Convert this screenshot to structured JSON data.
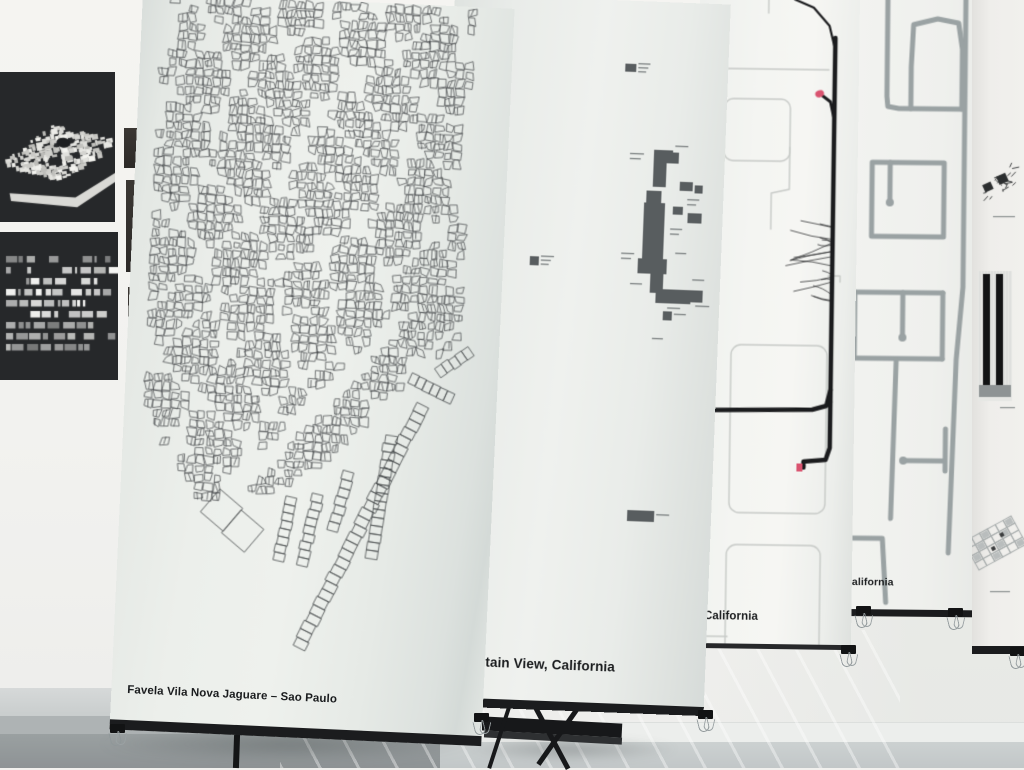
{
  "labels": {
    "banner1": "Favela Vila Nova Jaguare – Sao Paulo",
    "banner2": "tain View, California",
    "banner3": ", California",
    "banner3_faint": "n",
    "banner4": "alifornia"
  },
  "colors": {
    "mapLine": "#3d4143",
    "campus": "#585d5f",
    "campusDash": "#73787a",
    "routeBlack": "#1b1c1e",
    "routeGrey": "#c7cac7",
    "pink": "#d9536f",
    "road": "#9aa2a3",
    "art": "#26282a"
  },
  "favela": {
    "w": 372,
    "h": 730,
    "cell": 9,
    "seed": 11,
    "sil": [
      [
        30,
        0
      ],
      [
        338,
        0
      ],
      [
        334,
        62
      ],
      [
        324,
        132
      ],
      [
        330,
        212
      ],
      [
        342,
        272
      ],
      [
        334,
        338
      ],
      [
        300,
        368
      ],
      [
        266,
        402
      ],
      [
        232,
        434
      ],
      [
        204,
        458
      ],
      [
        178,
        482
      ],
      [
        148,
        496
      ],
      [
        104,
        508
      ],
      [
        80,
        510
      ],
      [
        58,
        472
      ],
      [
        36,
        446
      ],
      [
        26,
        420
      ],
      [
        20,
        392
      ],
      [
        30,
        350
      ],
      [
        16,
        318
      ],
      [
        22,
        280
      ],
      [
        16,
        240
      ],
      [
        26,
        200
      ],
      [
        14,
        164
      ],
      [
        30,
        124
      ],
      [
        18,
        80
      ],
      [
        42,
        44
      ]
    ],
    "streets": [
      [
        262,
        330,
        108,
        500,
        9
      ],
      [
        330,
        344,
        296,
        370,
        6
      ]
    ],
    "ladders": [
      [
        298,
        400,
        185,
        648,
        13,
        30
      ],
      [
        312,
        368,
        344,
        344,
        11,
        5
      ],
      [
        284,
        374,
        328,
        392,
        11,
        6
      ],
      [
        268,
        432,
        254,
        556,
        12,
        15
      ],
      [
        198,
        494,
        184,
        566,
        11,
        9
      ],
      [
        172,
        498,
        160,
        562,
        11,
        8
      ],
      [
        228,
        470,
        214,
        530,
        11,
        7
      ]
    ],
    "squares": [
      [
        102,
        514,
        30,
        38
      ],
      [
        124,
        534,
        30,
        38
      ]
    ]
  },
  "campus": {
    "w": 276,
    "h": 710,
    "rects": [
      [
        173,
        63,
        11,
        8
      ],
      [
        205,
        148,
        19,
        13
      ],
      [
        205,
        161,
        13,
        24
      ],
      [
        223,
        150,
        7,
        11
      ],
      [
        199,
        189,
        15,
        12
      ],
      [
        197,
        201,
        21,
        56
      ],
      [
        193,
        257,
        29,
        15
      ],
      [
        206,
        272,
        13,
        19
      ],
      [
        212,
        287,
        35,
        14
      ],
      [
        247,
        287,
        12,
        12
      ],
      [
        232,
        179,
        13,
        9
      ],
      [
        247,
        182,
        8,
        8
      ],
      [
        226,
        204,
        10,
        8
      ],
      [
        241,
        210,
        14,
        10
      ],
      [
        85,
        259,
        9,
        9
      ],
      [
        220,
        309,
        9,
        9
      ],
      [
        192,
        509,
        27,
        11
      ]
    ],
    "dashes": [
      [
        186,
        62,
        12
      ],
      [
        186,
        66,
        10
      ],
      [
        186,
        70,
        8
      ],
      [
        181,
        152,
        14
      ],
      [
        181,
        157,
        11
      ],
      [
        226,
        143,
        13
      ],
      [
        240,
        196,
        12
      ],
      [
        240,
        201,
        9
      ],
      [
        224,
        226,
        12
      ],
      [
        224,
        231,
        9
      ],
      [
        176,
        252,
        13
      ],
      [
        176,
        257,
        10
      ],
      [
        230,
        250,
        11
      ],
      [
        186,
        282,
        12
      ],
      [
        224,
        305,
        13
      ],
      [
        248,
        276,
        12
      ],
      [
        252,
        302,
        14
      ],
      [
        96,
        258,
        13
      ],
      [
        96,
        262,
        10
      ],
      [
        96,
        266,
        8
      ],
      [
        231,
        311,
        12
      ],
      [
        221,
        512,
        13
      ],
      [
        210,
        336,
        11
      ]
    ]
  },
  "route": {
    "w": 160,
    "h": 652,
    "grey": [
      {
        "t": "l",
        "p": [
          [
            14,
            72
          ],
          [
            130,
            72
          ]
        ]
      },
      {
        "t": "l",
        "p": [
          [
            69,
            0
          ],
          [
            69,
            16
          ]
        ]
      },
      {
        "t": "r",
        "x": 26,
        "y": 102,
        "w": 66,
        "h": 62,
        "r": 9
      },
      {
        "t": "l",
        "p": [
          [
            92,
            150
          ],
          [
            92,
            192
          ],
          [
            74,
            196
          ],
          [
            74,
            232
          ]
        ]
      },
      {
        "t": "r",
        "x": 36,
        "y": 348,
        "w": 96,
        "h": 168,
        "r": 10
      },
      {
        "t": "r",
        "x": 34,
        "y": 548,
        "w": 94,
        "h": 130,
        "r": 10
      },
      {
        "t": "l",
        "p": [
          [
            14,
            640
          ],
          [
            36,
            640
          ]
        ]
      },
      {
        "t": "l",
        "p": [
          [
            132,
            278
          ],
          [
            144,
            278
          ],
          [
            144,
            284
          ]
        ]
      }
    ],
    "black": [
      {
        "w": 2.2,
        "p": [
          [
            95,
            2
          ],
          [
            114,
            10
          ],
          [
            130,
            28
          ],
          [
            136,
            52
          ]
        ]
      },
      {
        "w": 4.5,
        "p": [
          [
            136,
            40
          ],
          [
            136,
            404
          ]
        ]
      },
      {
        "w": 3,
        "p": [
          [
            136,
            122
          ],
          [
            132,
            104
          ],
          [
            124,
            98
          ]
        ]
      },
      {
        "w": 4.5,
        "p": [
          [
            136,
            392
          ],
          [
            132,
            408
          ],
          [
            118,
            412
          ],
          [
            0,
            414
          ]
        ]
      },
      {
        "w": 4.5,
        "p": [
          [
            136,
            404
          ],
          [
            136,
            450
          ],
          [
            132,
            462
          ],
          [
            110,
            464
          ],
          [
            110,
            470
          ]
        ]
      }
    ],
    "hair": {
      "x": 136,
      "y1": 222,
      "y2": 312,
      "n": 18,
      "seed": 5
    },
    "pinkBlob": [
      121,
      96
    ],
    "pinkSq": [
      103,
      466
    ]
  },
  "suburb": {
    "w": 174,
    "h": 620,
    "roads": [
      [
        [
          116,
          0
        ],
        [
          116,
          290
        ],
        [
          110,
          362
        ],
        [
          104,
          556
        ]
      ],
      [
        [
          38,
          0
        ],
        [
          38,
          100
        ],
        [
          39,
          110
        ],
        [
          50,
          112
        ],
        [
          113,
          112
        ]
      ],
      [
        [
          62,
          112
        ],
        [
          62,
          70
        ],
        [
          64,
          28
        ],
        [
          88,
          22
        ],
        [
          109,
          26
        ],
        [
          113,
          52
        ],
        [
          113,
          112
        ]
      ],
      [
        [
          24,
          240
        ],
        [
          24,
          166
        ],
        [
          96,
          166
        ],
        [
          96,
          240
        ],
        [
          24,
          240
        ]
      ],
      [
        [
          42,
          166
        ],
        [
          42,
          203
        ]
      ],
      [
        [
          8,
          296
        ],
        [
          96,
          296
        ]
      ],
      [
        [
          8,
          296
        ],
        [
          8,
          362
        ],
        [
          96,
          362
        ]
      ],
      [
        [
          96,
          296
        ],
        [
          96,
          362
        ]
      ],
      [
        [
          56,
          296
        ],
        [
          56,
          338
        ]
      ],
      [
        [
          50,
          364
        ],
        [
          46,
          522
        ]
      ],
      [
        [
          58,
          464
        ],
        [
          99,
          464
        ]
      ],
      [
        [
          100,
          432
        ],
        [
          100,
          474
        ]
      ],
      [
        [
          0,
          542
        ],
        [
          38,
          542
        ],
        [
          42,
          606
        ]
      ]
    ],
    "dots": [
      [
        42,
        206
      ],
      [
        56,
        341
      ],
      [
        58,
        464
      ]
    ]
  },
  "panel5": {
    "w": 52,
    "h": 656,
    "sketch": {
      "x": 3,
      "y": 165,
      "w": 44,
      "h": 42,
      "seed": 9
    },
    "bars": {
      "x": 6,
      "y": 273,
      "w": 34,
      "h": 124
    },
    "fan": {
      "x": -2,
      "y": 512,
      "w": 50,
      "h": 66
    },
    "dashes": [
      [
        21,
        218,
        22
      ],
      [
        28,
        409,
        15
      ],
      [
        18,
        593,
        20
      ]
    ]
  },
  "artA": {
    "w": 115,
    "h": 150,
    "seed": 3
  },
  "artB": {
    "w": 118,
    "h": 148,
    "rows": 9,
    "seed": 4
  },
  "hardware": {
    "clips": [
      [
        110,
        724
      ],
      [
        474,
        713
      ],
      [
        698,
        710
      ],
      [
        841,
        645
      ],
      [
        856,
        606
      ],
      [
        948,
        608
      ],
      [
        1010,
        647
      ]
    ]
  }
}
